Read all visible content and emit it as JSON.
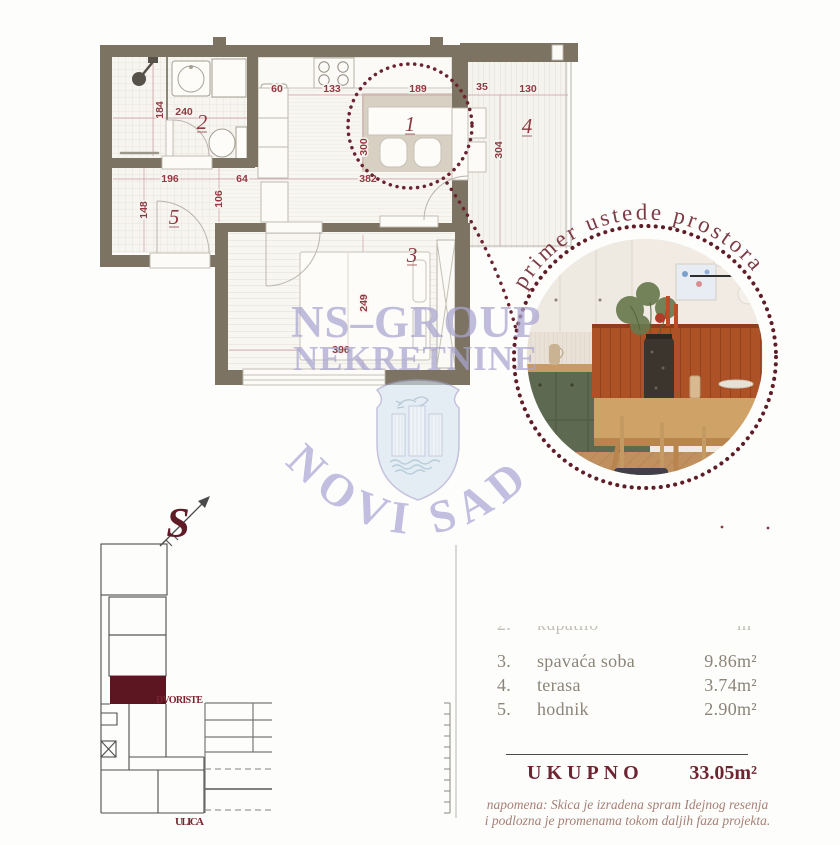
{
  "plan": {
    "rooms": {
      "r1": "1",
      "r2": "2",
      "r3": "3",
      "r4": "4",
      "r5": "5"
    },
    "dims": {
      "d184": "184",
      "d240": "240",
      "d60": "60",
      "d133": "133",
      "d189": "189",
      "d35": "35",
      "d130": "130",
      "d300": "300",
      "d304": "304",
      "d382": "382",
      "d196": "196",
      "d64": "64",
      "d106": "106",
      "d148": "148",
      "d249": "249",
      "d396": "396"
    }
  },
  "inset": {
    "caption": "primer ustede prostora"
  },
  "watermark": {
    "brand_line1": "NS–GROUP",
    "brand_line2": "NEKRETNINE",
    "city": "NOVI SAD"
  },
  "compass": {
    "north_letter": "S"
  },
  "siteplan": {
    "courtyard": "DVORISTE",
    "street": "ULICA"
  },
  "area_table": {
    "clipped_row": {
      "num": "2.",
      "label": "kupatilo",
      "value": "m²"
    },
    "rows": [
      {
        "num": "3.",
        "label": "spavaća soba",
        "value": "9.86m²"
      },
      {
        "num": "4.",
        "label": "terasa",
        "value": "3.74m²"
      },
      {
        "num": "5.",
        "label": "hodnik",
        "value": "2.90m²"
      }
    ],
    "total_label": "UKUPNO",
    "total_value": "33.05m²",
    "note_line1": "napomena: Skica je izradena spram Idejnog resenja",
    "note_line2": "i podlozna je promenama tokom daljih faza projekta."
  },
  "colors": {
    "dim_maroon": "#8e3a42",
    "accent_dark": "#5f1c27",
    "wall_olive": "#7c7363",
    "watermark_purple": "#a9a5d1",
    "highlight_red": "#5c1622"
  }
}
